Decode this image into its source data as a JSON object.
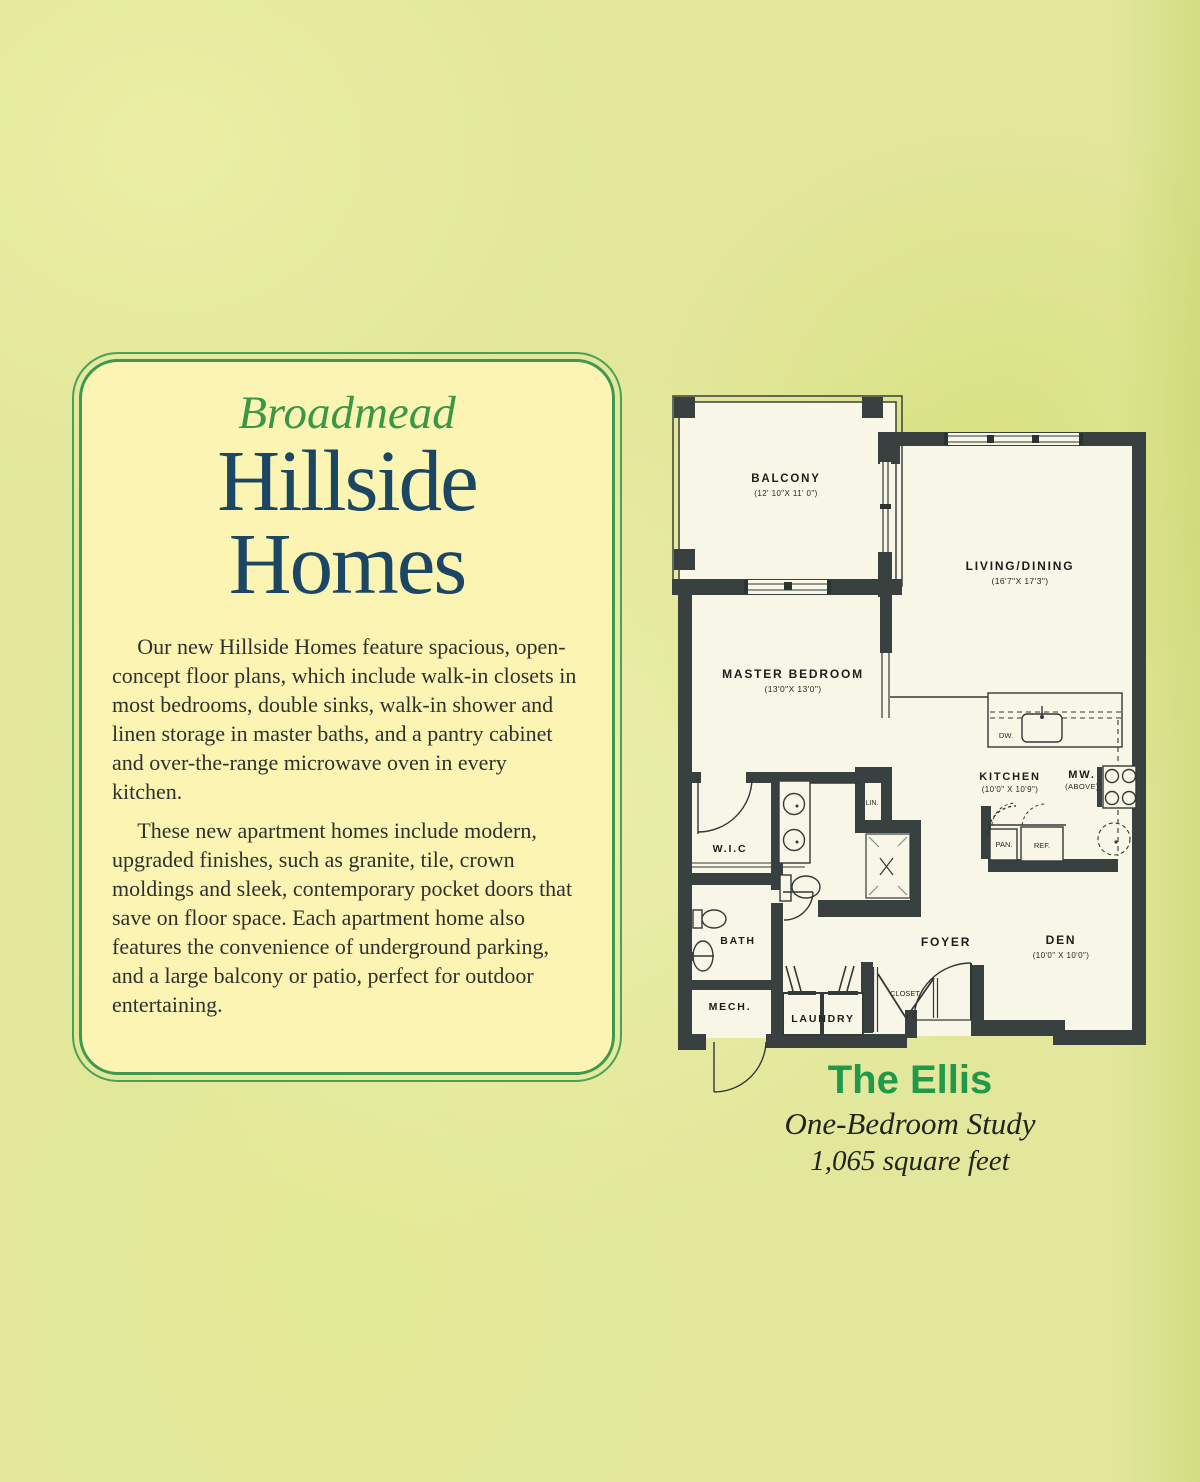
{
  "colors": {
    "background": "#e2e79b",
    "card_fill": "#fbf4b2",
    "card_border_green": "#3f9750",
    "brand_green": "#3a9745",
    "title_navy": "#1b4765",
    "body_text": "#30302e",
    "ellis_green": "#21994b",
    "plan_wall": "#384040",
    "plan_floor": "#f8f6e7"
  },
  "card": {
    "brand": "Broadmead",
    "title_line1": "Hillside",
    "title_line2": "Homes",
    "paragraph1": "Our new Hillside Homes feature spacious, open-concept floor plans, which include walk-in closets in most bedrooms, double sinks, walk-in shower and linen storage in master baths, and a pantry cabinet and over-the-range microwave oven in every kitchen.",
    "paragraph2": "These new apartment homes include modern, upgraded finishes, such as granite, tile, crown moldings and sleek, contemporary pocket doors that save on floor space. Each apartment home also features the convenience of underground parking, and a large balcony or patio, perfect for outdoor entertaining."
  },
  "floorplan": {
    "labels": {
      "balcony": {
        "name": "BALCONY",
        "dims": "(12' 10\"X 11' 0\")"
      },
      "living": {
        "name": "LIVING/DINING",
        "dims": "(16'7\"X 17'3\")"
      },
      "master": {
        "name": "MASTER BEDROOM",
        "dims": "(13'0\"X 13'0\")"
      },
      "kitchen": {
        "name": "KITCHEN",
        "dims": "(10'0\" X 10'9\")"
      },
      "den": {
        "name": "DEN",
        "dims": "(10'0\" X 10'0\")"
      },
      "mw": {
        "name": "MW.",
        "sub": "(ABOVE)"
      },
      "wic": "W.I.C",
      "lin": "LIN.",
      "bath": "BATH",
      "foyer": "FOYER",
      "mech": "MECH.",
      "laundry": "LAUNDRY",
      "closet": "CLOSET",
      "pan": "PAN.",
      "ref": "REF.",
      "dw": "DW."
    }
  },
  "caption": {
    "title": "The Ellis",
    "subtitle": "One-Bedroom Study",
    "area": "1,065 square feet"
  }
}
